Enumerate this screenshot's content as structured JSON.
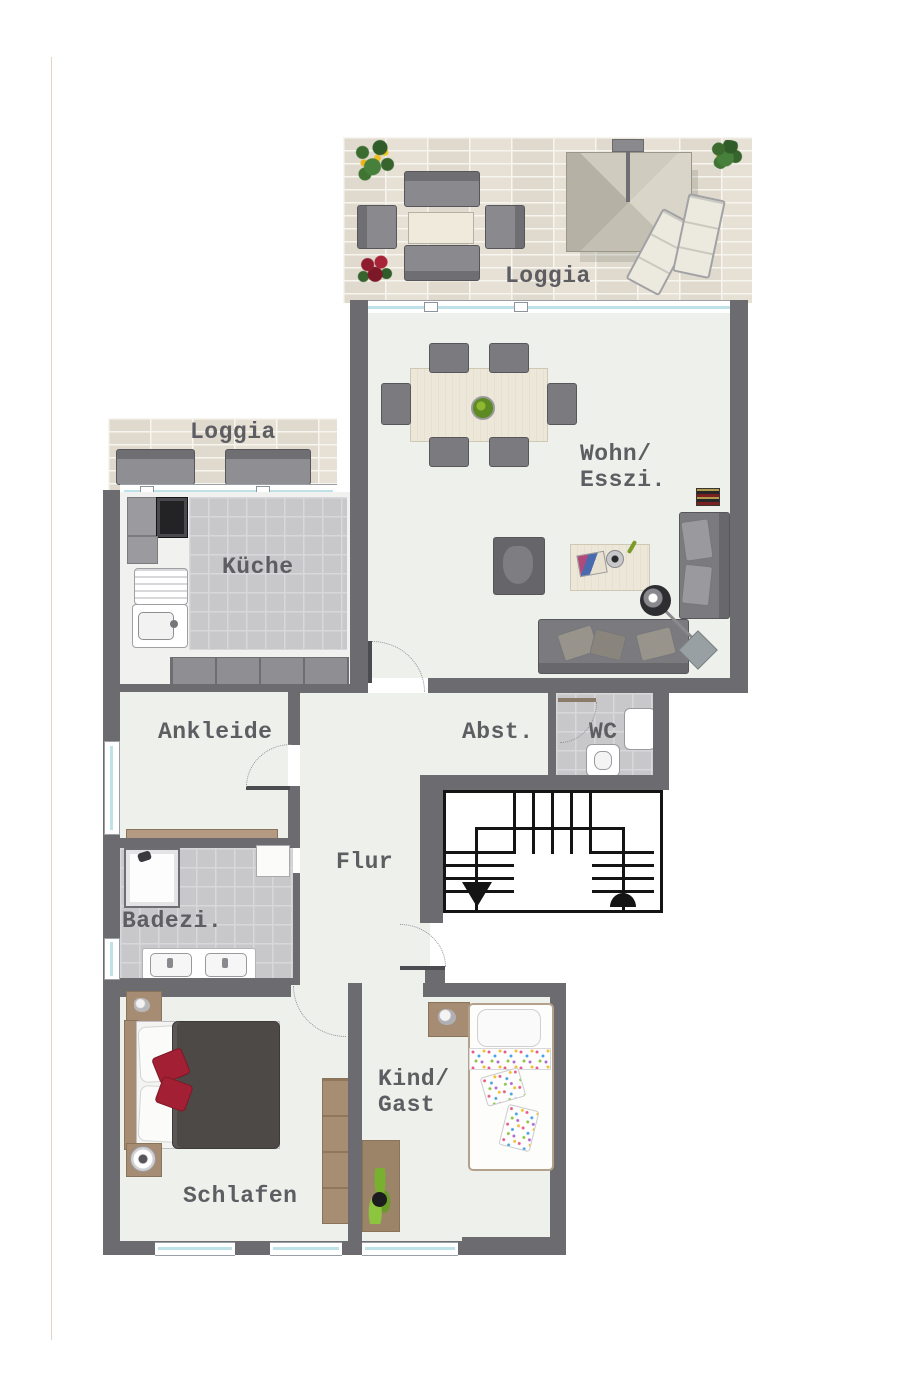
{
  "plan_title": "apartment-floor-plan",
  "rooms": {
    "loggia_top": {
      "label": "Loggia"
    },
    "wohn_esszi": {
      "label_line1": "Wohn/",
      "label_line2": "Esszi."
    },
    "loggia_small": {
      "label": "Loggia"
    },
    "kueche": {
      "label": "Küche"
    },
    "ankleide": {
      "label": "Ankleide"
    },
    "abstellraum": {
      "label": "Abst."
    },
    "wc": {
      "label": "WC"
    },
    "flur": {
      "label": "Flur"
    },
    "badezimmer": {
      "label": "Badezi."
    },
    "schlafen": {
      "label": "Schlafen"
    },
    "kind_gast": {
      "label_line1": "Kind/",
      "label_line2": "Gast"
    }
  },
  "colors": {
    "wall": "#6b6b70",
    "floor": "#eef0ec",
    "tile": "#c8c8ca",
    "tile_line": "#d8d8da",
    "loggia_floor": "#e7e1d5",
    "label_text": "#5d5d62",
    "window_glass": "#bfe2e8",
    "stair_ink": "#141414",
    "sofa": "#7b7b7f",
    "sofa_dark": "#57575b",
    "wood": "#a58c72",
    "wood_light": "#eae5d4",
    "duvet": "#4d4947",
    "accent_red": "#a32034"
  }
}
